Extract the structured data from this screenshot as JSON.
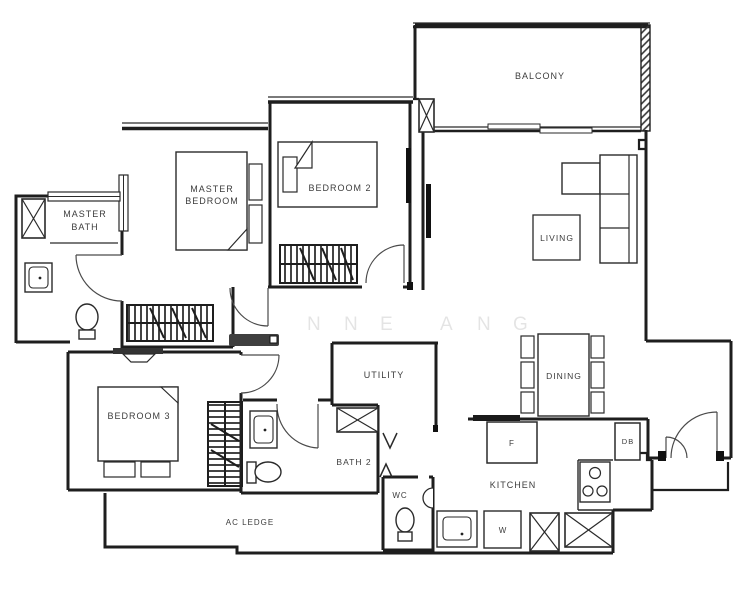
{
  "plan": {
    "title": "apartment-floor-plan",
    "watermark_letters": [
      "N",
      "N",
      "E",
      "A",
      "N",
      "G"
    ],
    "rooms": {
      "balcony": "BALCONY",
      "living": "LIVING",
      "dining": "DINING",
      "kitchen": "KITCHEN",
      "master_bedroom_line1": "MASTER",
      "master_bedroom_line2": "BEDROOM",
      "master_bath_line1": "MASTER",
      "master_bath_line2": "BATH",
      "bedroom2": "BEDROOM 2",
      "bedroom3": "BEDROOM 3",
      "utility": "UTILITY",
      "bath2": "BATH 2",
      "wc": "WC",
      "ac_ledge": "AC LEDGE"
    },
    "fixtures": {
      "fridge": "F",
      "washer": "W",
      "distribution_board": "DB"
    },
    "colors": {
      "wall": "#1e1e1e",
      "text": "#3c3c3c",
      "background": "#ffffff"
    }
  }
}
